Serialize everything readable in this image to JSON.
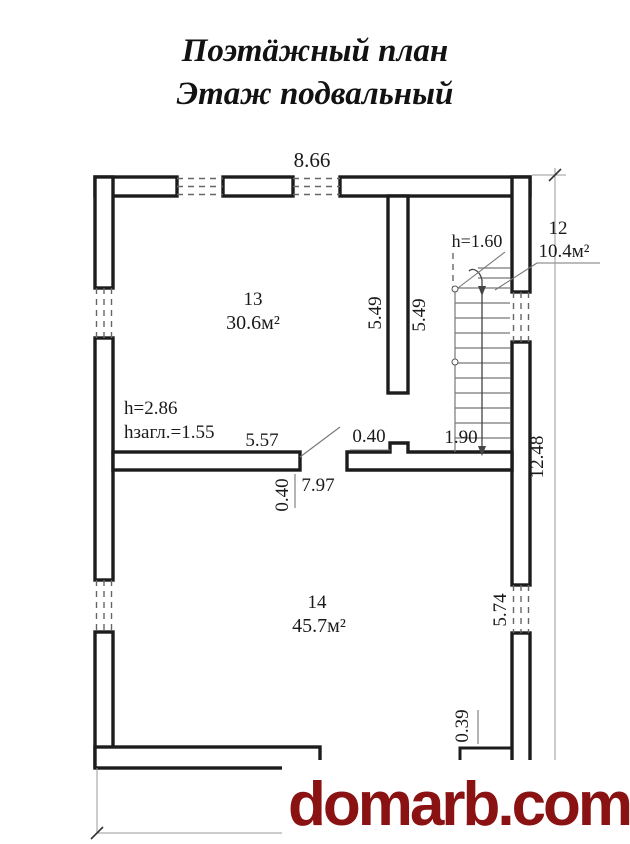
{
  "title": {
    "line1": "Поэтäжный план",
    "line2": "Этаж подвальный"
  },
  "rooms": [
    {
      "number": "13",
      "area": "30.6м²"
    },
    {
      "number": "14",
      "area": "45.7м²"
    },
    {
      "number": "12",
      "area": "10.4м²"
    }
  ],
  "annotations": {
    "ceiling_height": "h=2.86",
    "basement_depth": "hзагл.=1.55",
    "stair_clearance": "h=1.60"
  },
  "dimensions": {
    "top_width": "8.66",
    "stair_wall_left": "5.49",
    "stair_wall_right": "5.49",
    "room13_width": "5.57",
    "opening_width": "0.40",
    "stair_hall_width": "1.90",
    "room14_width": "7.97",
    "mid_wall_thickness": "0.40",
    "total_height_right": "12.48",
    "room14_height_right": "5.74",
    "bottom_step": "0.39"
  },
  "watermark": {
    "text": "domarb.com",
    "color": "#8a1212"
  }
}
